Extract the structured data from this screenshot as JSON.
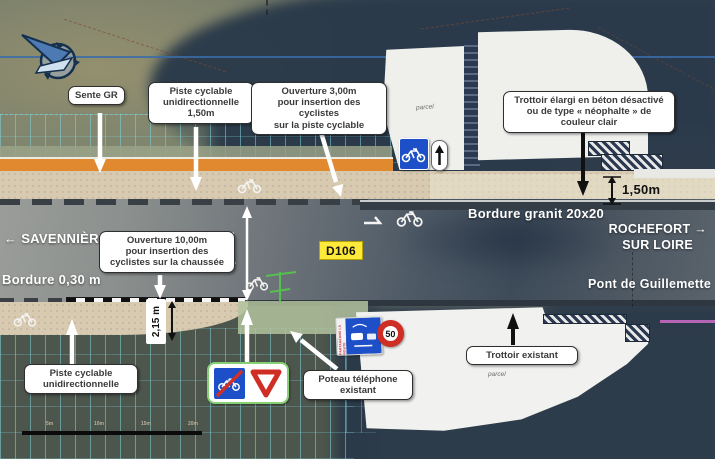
{
  "colors": {
    "orange": "#E0892F",
    "beige": "#D7CAB0",
    "badge_yellow": "#FFE93B",
    "sign_blue": "#1D50C8",
    "sign_red": "#CF2E24",
    "green_border": "#86CF72",
    "hatch_cyan": "#7FD2DE"
  },
  "callouts": {
    "sente_gr": "Sente GR",
    "piste_cyclable_haut": "Piste cyclable\nunidirectionnelle\n1,50m",
    "ouverture_3m": "Ouverture 3,00m\npour insertion des cyclistes\nsur la piste cyclable",
    "trottoir_elargi": "Trottoir élargi en béton désactivé\nou de type « néophalte » de\ncouleur clair",
    "ouverture_10m": "Ouverture 10,00m\npour insertion des\ncyclistes sur la chaussée",
    "piste_cyclable_bas": "Piste cyclable\nunidirectionnelle",
    "poteau_telephone": "Poteau téléphone\nexistant",
    "trottoir_existant": "Trottoir existant"
  },
  "road_texts": {
    "direction_left": "← SAVENNIÈRES",
    "route_number": "D106",
    "bordure_granit": "Bordure  granit 20x20",
    "direction_right_line1": "ROCHEFORT →",
    "direction_right_line2": "SUR LOIRE",
    "bridge": "Pont de Guillemette",
    "bordure_030": "Bordure  0,30 m"
  },
  "dimensions": {
    "road_width": "5,50 m",
    "piste_width": "2,15 m",
    "trottoir_width": "1,50m"
  },
  "signs": {
    "speed_limit": "50",
    "partageons": "PARTAGEONS LA ROUTE"
  },
  "parcels": {
    "top": "parcel",
    "bottom": "parcel"
  },
  "scalebar": {
    "labels": [
      "5m",
      "10m",
      "15m",
      "20m"
    ]
  }
}
